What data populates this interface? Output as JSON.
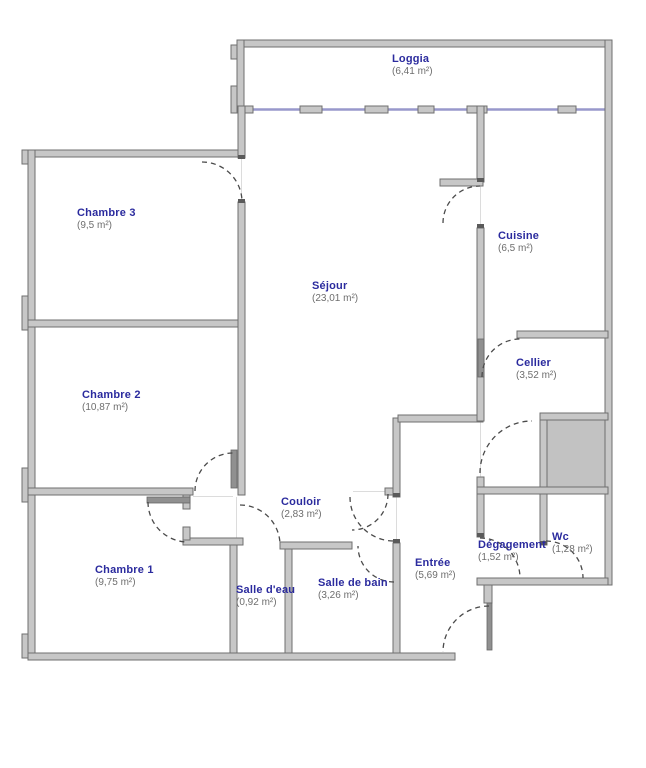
{
  "title": "floor-plan",
  "rooms": [
    {
      "name": "Loggia",
      "area_label": "(6,41 m²)"
    },
    {
      "name": "Chambre 3",
      "area_label": "(9,5 m²)"
    },
    {
      "name": "Séjour",
      "area_label": "(23,01 m²)"
    },
    {
      "name": "Cuisine",
      "area_label": "(6,5 m²)"
    },
    {
      "name": "Cellier",
      "area_label": "(3,52 m²)"
    },
    {
      "name": "Chambre 2",
      "area_label": "(10,87 m²)"
    },
    {
      "name": "Couloir",
      "area_label": "(2,83 m²)"
    },
    {
      "name": "Chambre 1",
      "area_label": "(9,75 m²)"
    },
    {
      "name": "Salle d'eau",
      "area_label": "(0,92 m²)"
    },
    {
      "name": "Salle de bain",
      "area_label": "(3,26 m²)"
    },
    {
      "name": "Entrée",
      "area_label": "(5,69 m²)"
    },
    {
      "name": "Dégagement",
      "area_label": "(1,52 m²)"
    },
    {
      "name": "Wc",
      "area_label": "(1,28 m²)"
    }
  ],
  "colors": {
    "wall_fill": "#c7c7c7",
    "wall_stroke": "#6f6f6f",
    "door_leaf": "#909090",
    "door_arc": "#4a4a4a",
    "window": "#9898cc",
    "shaft_fill": "#c2c2c2",
    "room_name_text": "#2b2b9e",
    "room_area_text": "#6e6e6e",
    "background": "#ffffff"
  }
}
